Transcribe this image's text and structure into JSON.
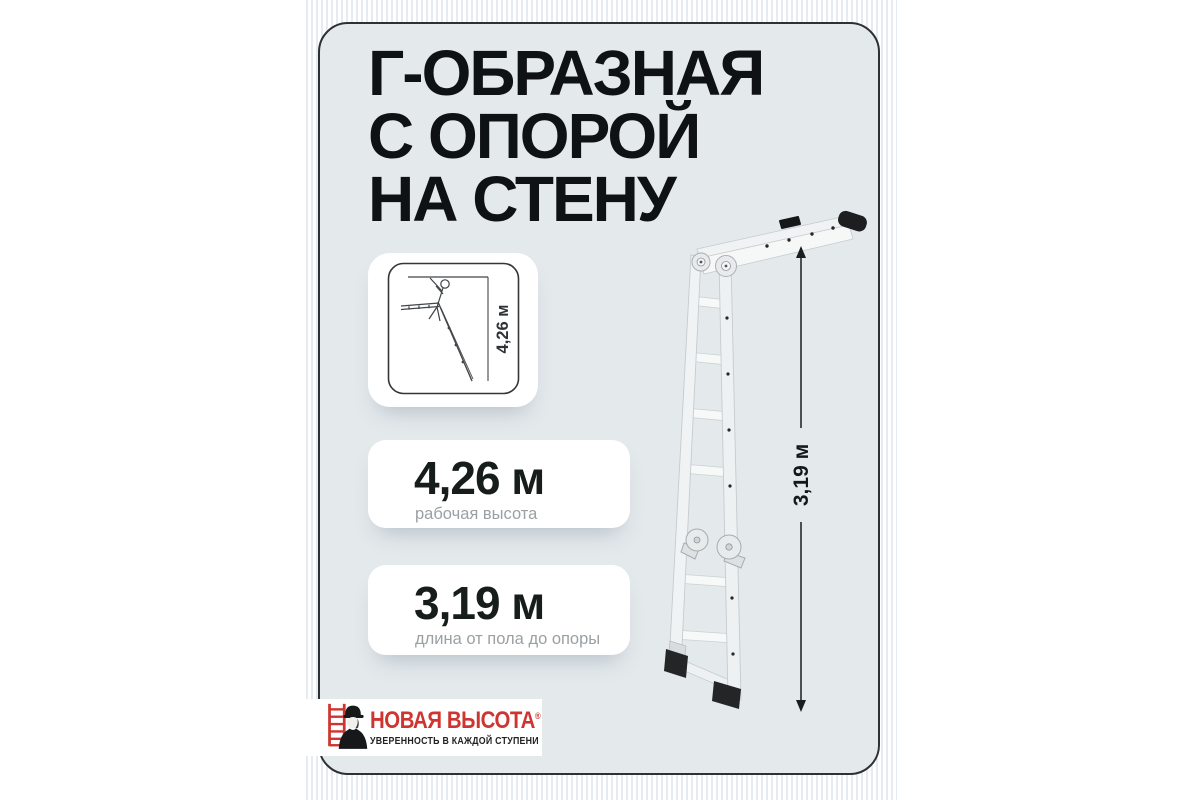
{
  "card": {
    "title_lines": [
      "Г-ОБРАЗНАЯ",
      "С ОПОРОЙ",
      "НА СТЕНУ"
    ]
  },
  "diagram": {
    "dimension_label": "4,26 м"
  },
  "specs": [
    {
      "value": "4,26 м",
      "label": "рабочая высота"
    },
    {
      "value": "3,19 м",
      "label": "длина от пола до опоры"
    }
  ],
  "illustration": {
    "dimension_label": "3,19 м"
  },
  "logo": {
    "brand": "НОВАЯ ВЫСОТА",
    "registered": "®",
    "tagline": "УВЕРЕННОСТЬ В КАЖДОЙ СТУПЕНИ"
  },
  "colors": {
    "brand_red": "#cf3530",
    "card_bg": "#e4e9ec",
    "stripe": "#e5ebf1",
    "title_text": "#0f1214",
    "value_text": "#161d1a",
    "muted_text": "#9aa0a4",
    "dimension_line": "#1a1d1f"
  }
}
